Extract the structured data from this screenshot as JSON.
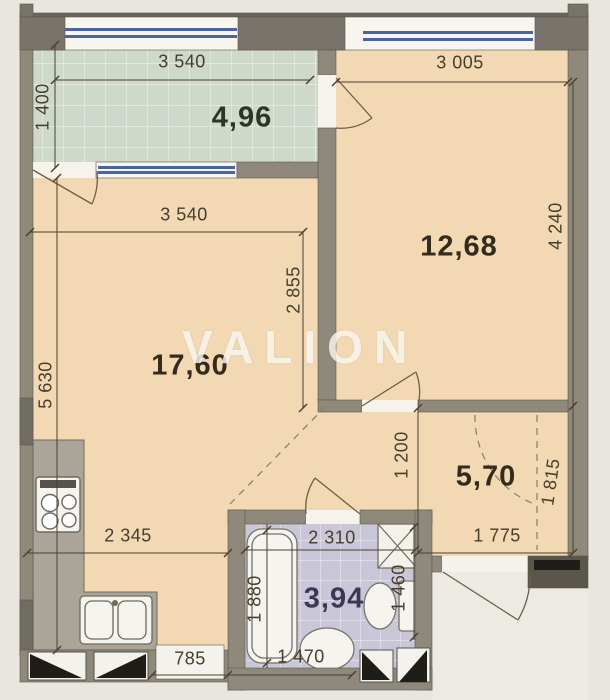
{
  "watermark": "VALION",
  "rooms": {
    "balcony": "4,96",
    "bedroom": "12,68",
    "living": "17,60",
    "hall": "5,70",
    "bathroom": "3,94"
  },
  "dimensions": {
    "balcony_width": "3 540",
    "balcony_depth": "1 400",
    "bedroom_width": "3 005",
    "bedroom_height": "4 240",
    "living_width": "3 540",
    "living_height": "5 630",
    "living_right_height": "2 855",
    "hall_left_height": "1 200",
    "hall_right_height": "1 815",
    "hall_width": "1 775",
    "kitchen_width": "2 345",
    "bathroom_width": "2 310",
    "bathroom_left_height": "1 880",
    "bathroom_right_height": "1 460",
    "sink_offset": "785",
    "bathtub_length": "1 470"
  },
  "colors": {
    "background": "#e9e6df",
    "floor": "#f2d9b4",
    "balcony_floor": "#cfd9cb",
    "bathroom_floor": "#c9c6d7",
    "wall": "#8f897c",
    "glazing": "#49659e",
    "dimension_text": "#473d2c"
  }
}
